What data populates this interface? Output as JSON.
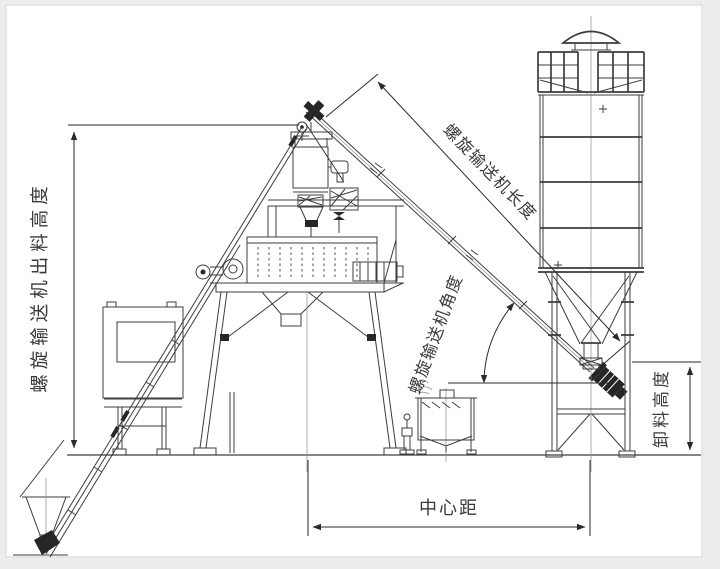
{
  "diagram": {
    "title": "concrete-batching-plant-dimension-drawing",
    "labels": {
      "conveyor_discharge_height": "螺旋输送机出料高度",
      "conveyor_length": "螺旋输送机长度",
      "conveyor_angle": "螺旋输送机角度",
      "unload_height": "卸料高度",
      "center_distance": "中心距"
    },
    "colors": {
      "line": "#3d3d3d",
      "dim": "#2a2a2a",
      "text": "#3a3a3a",
      "background": "#ffffff",
      "margin": "#ededed",
      "border": "#d6d6d6"
    }
  }
}
